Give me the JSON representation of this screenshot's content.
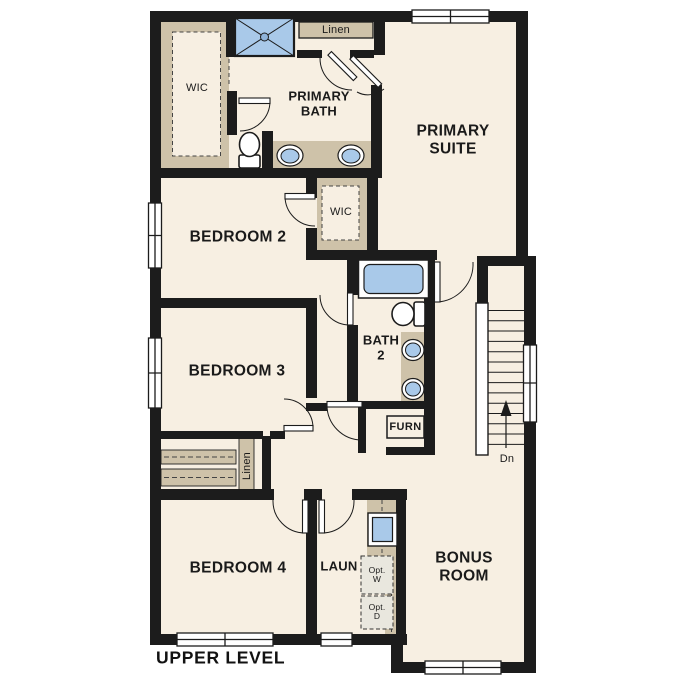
{
  "title": "UPPER LEVEL",
  "labels": {
    "wic_primary": "WIC",
    "linen_top": "Linen",
    "primary_bath": "PRIMARY\nBATH",
    "primary_suite": "PRIMARY\nSUITE",
    "bedroom2": "BEDROOM 2",
    "wic_bedroom2": "WIC",
    "bedroom3": "BEDROOM 3",
    "bath2": "BATH\n2",
    "furnace": "FURN",
    "linen_hall": "Linen",
    "bedroom4": "BEDROOM 4",
    "laundry": "LAUN",
    "opt_washer": "Opt.\nW",
    "opt_dryer": "Opt.\nD",
    "bonus_room": "BONUS\nROOM",
    "stair_direction": "Dn"
  },
  "colors": {
    "wall": "#1c1c1c",
    "floor": "#f7efe2",
    "casework_tan": "#cec2a9",
    "fixture_blue": "#a9c9e9",
    "window_white": "#ffffff",
    "optional_gray": "#e9e7de"
  }
}
